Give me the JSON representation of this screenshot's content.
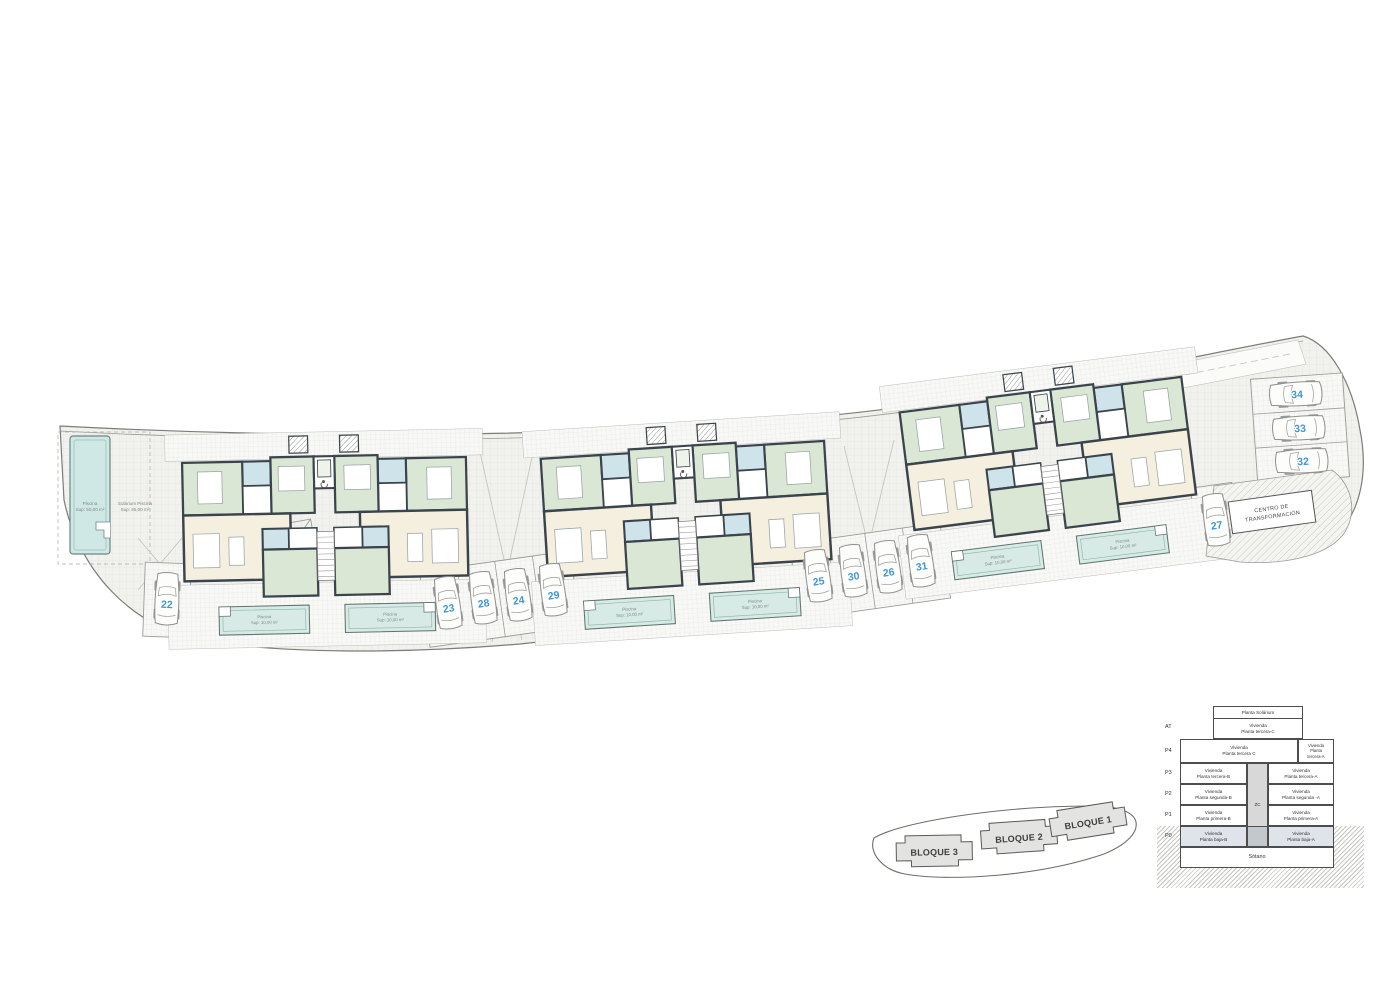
{
  "plan": {
    "cars": {
      "c22": "22",
      "c23": "23",
      "c24": "24",
      "c25": "25",
      "c26": "26",
      "c27": "27",
      "c28": "28",
      "c29": "29",
      "c30": "30",
      "c31": "31",
      "c32": "32",
      "c33": "33",
      "c34": "34"
    },
    "communal_pool": {
      "line1": "Piscina",
      "line2": "Sup: 50,00 m²"
    },
    "solarium": {
      "line1": "Solárium Piscina",
      "line2": "Sup: 95,00 m²"
    },
    "private_pool": {
      "line1": "Piscina",
      "line2": "Sup: 10,00 m²"
    },
    "centro": {
      "line1": "CENTRO DE",
      "line2": "TRANSFORMACIÓN"
    }
  },
  "key": {
    "blocks": [
      {
        "label": "BLOQUE 3"
      },
      {
        "label": "BLOQUE 2"
      },
      {
        "label": "BLOQUE 1"
      }
    ]
  },
  "legend": {
    "solarium": "Planta Solárium",
    "at": {
      "label": "AT",
      "line1": "Vivienda",
      "line2": "Planta tercera-C"
    },
    "p4": {
      "label": "P4",
      "left1": "Vivienda",
      "left2": "Planta tercera C",
      "right1": "Vivienda",
      "right2": "Planta",
      "right3": "tercera-A"
    },
    "zc": "ZC",
    "rows": [
      {
        "label": "P3",
        "left1": "Vivienda",
        "left2": "Planta tercera-B",
        "right1": "Vivienda",
        "right2": "Planta tercera-A"
      },
      {
        "label": "P2",
        "left1": "Vivienda",
        "left2": "Planta segunda-B",
        "right1": "Vivienda",
        "right2": "Planta segunda -A"
      },
      {
        "label": "P1",
        "left1": "Vivienda",
        "left2": "Planta primera-B",
        "right1": "Vivienda",
        "right2": "Planta primera-A"
      },
      {
        "label": "P0",
        "left1": "Vivienda",
        "left2": "Planta baja-B",
        "right1": "Vivienda",
        "right2": "Planta baja-A"
      }
    ],
    "sotano": "Sótano"
  }
}
